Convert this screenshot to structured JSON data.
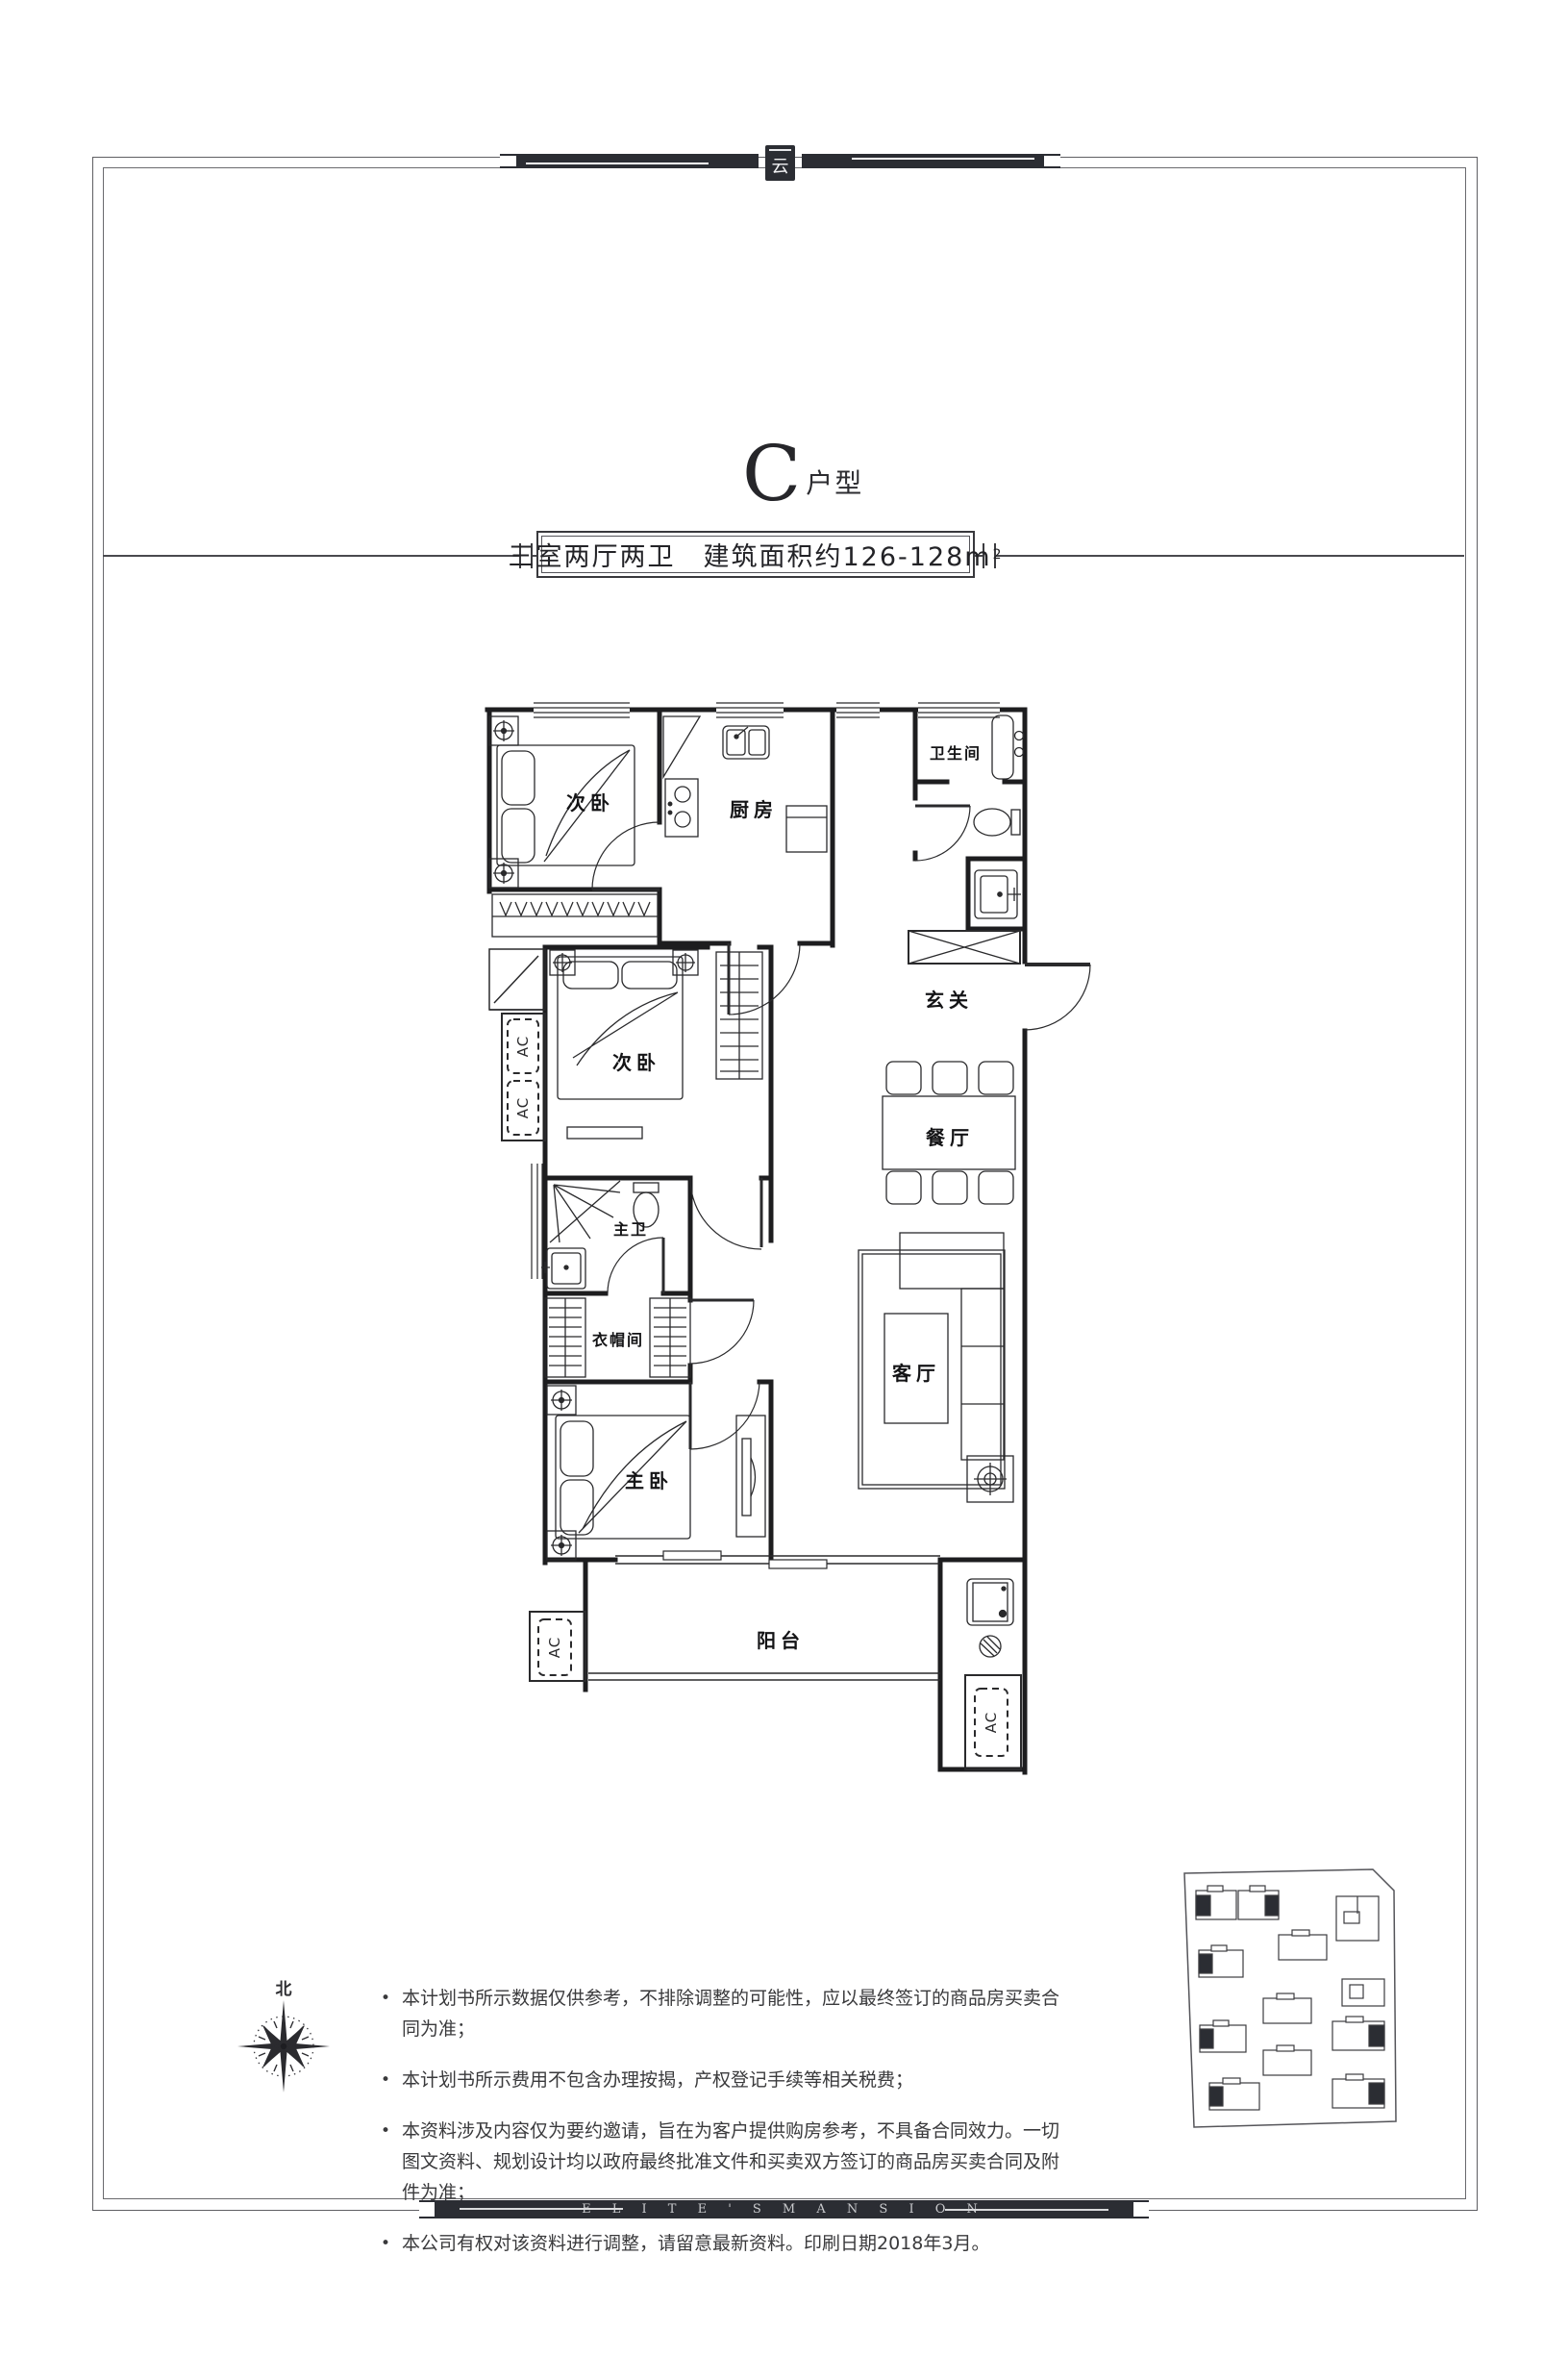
{
  "brand": {
    "badge_glyph": "云",
    "footer_text": "E L I T E ' S M A N S I O N"
  },
  "header": {
    "title_letter": "C",
    "title_suffix": "户型",
    "subtitle": "三室两厅两卫　建筑面积约126-128m",
    "subtitle_sup": "2"
  },
  "plan": {
    "ac_label": "AC",
    "rooms": [
      {
        "label": "次卧"
      },
      {
        "label": "厨房"
      },
      {
        "label": "卫生间"
      },
      {
        "label": "玄关"
      },
      {
        "label": "次卧"
      },
      {
        "label": "餐厅"
      },
      {
        "label": "主卫"
      },
      {
        "label": "衣帽间"
      },
      {
        "label": "客厅"
      },
      {
        "label": "主卧"
      },
      {
        "label": "阳台"
      }
    ]
  },
  "compass": {
    "north_label": "北"
  },
  "notes": {
    "items": [
      "本计划书所示数据仅供参考，不排除调整的可能性，应以最终签订的商品房买卖合同为准；",
      "本计划书所示费用不包含办理按揭，产权登记手续等相关税费；",
      "本资料涉及内容仅为要约邀请，旨在为客户提供购房参考，不具备合同效力。一切图文资料、规划设计均以政府最终批准文件和买卖双方签订的商品房买卖合同及附件为准；",
      "本公司有权对该资料进行调整，请留意最新资料。印刷日期2018年3月。"
    ]
  }
}
